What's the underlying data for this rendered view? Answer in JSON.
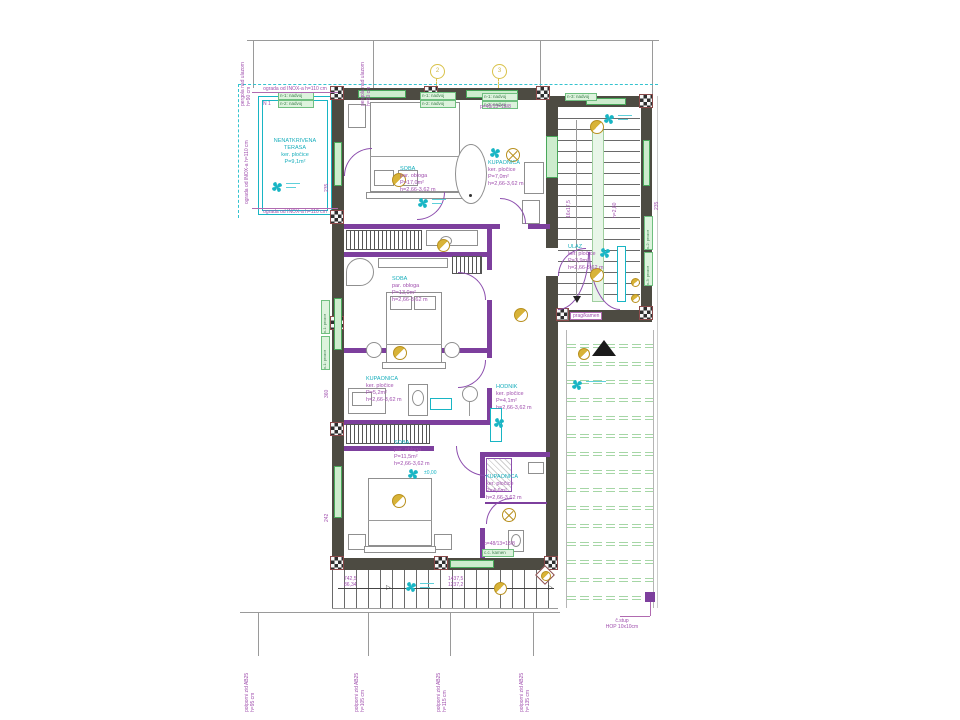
{
  "rooms": [
    {
      "lines": [
        "NENATKRIVENA",
        "TERASA",
        "ker. pločice",
        "P=9,1m²"
      ]
    },
    {
      "lines": [
        "SOBA",
        "par. obloga",
        "P=17,0m²",
        "h=2,66-3,62 m"
      ]
    },
    {
      "lines": [
        "KUPAONICA",
        "ker. pločice",
        "P=7,0m²",
        "h=2,66-3,62 m"
      ]
    },
    {
      "lines": [
        "ULAZ",
        "ker. pločice",
        "P=3,9m²",
        "h=2,66-3,62 m"
      ]
    },
    {
      "lines": [
        "SOBA",
        "par. obloga",
        "P=13,0m²",
        "h=2,66-3,62 m"
      ]
    },
    {
      "lines": [
        "KUPAONICA",
        "ker. pločice",
        "P=5,2m²",
        "h=2,66-3,62 m"
      ]
    },
    {
      "lines": [
        "HODNIK",
        "ker. pločice",
        "P=4,1m²",
        "h=2,66-3,62 m"
      ]
    },
    {
      "lines": [
        "SOBA",
        "par. obloga",
        "P=11,5m²",
        "h=2,66-3,62 m"
      ]
    },
    {
      "lines": [
        "KUPAONICA",
        "ker. pločice",
        "P=4,6m²",
        "h=2,66-3,62 m"
      ]
    }
  ],
  "ann": {
    "railing_top": "ograda od INOX-a h=110 cm",
    "railing_bottom": "ograda od INOX-a h=110 cm",
    "railing_left": "ograda od INOX-a h=110 cm",
    "corner_mark": "N 1",
    "prag": "prag/kamen",
    "column_line1": "č.stup",
    "column_line2": "HOP 10x10cm",
    "stair_formula_top": "p=48/13=18/8",
    "stair_formula_bottom": "p=48/13=18/8",
    "level": "±0,00"
  },
  "walls": [
    {
      "label": "potporni zid AB25",
      "h": "h=95 cm"
    },
    {
      "label": "potporni zid AB25",
      "h": "h=105 cm"
    },
    {
      "label": "potporni zid AB25",
      "h": "h=115 cm"
    },
    {
      "label": "potporni zid AB25",
      "h": "h=135 cm"
    }
  ],
  "pergola": [
    {
      "label": "pergola nad ulazom",
      "h": "h=90 cm"
    },
    {
      "label": "pergola nad ulazom",
      "h": "h=90 cm"
    }
  ],
  "dims": {
    "a": "742,5",
    "b": "86,34",
    "c": "1437,5",
    "d": "1237,2",
    "flight": "16x17,5",
    "flight_h": "h=2,80",
    "w1": "235",
    "w2": "360",
    "w3": "242",
    "w4": "235"
  },
  "tags": [
    "n-1: nadvoj",
    "n-2: nadvoj",
    "n-1: nadvoj",
    "n-2: nadvoj",
    "n-1: nadvoj",
    "n-2: nadvoj",
    "n-3: nadvoj",
    "c.c. kamen",
    "v-1: prozor",
    "v-1: prozor",
    "v-2: prozor",
    "v-3: prozor"
  ],
  "grid": [
    "2",
    "3"
  ],
  "icons": {
    "arrow_right": "▷",
    "arrow_down": "▼"
  },
  "colors": {
    "wall": "#4d4b42",
    "partition": "#7d3f9d",
    "cyan": "#18b5c4",
    "green": "#49a85a",
    "magenta": "#a04fae",
    "gold": "#c9a227",
    "pergola_line": "#a5d6a5"
  }
}
